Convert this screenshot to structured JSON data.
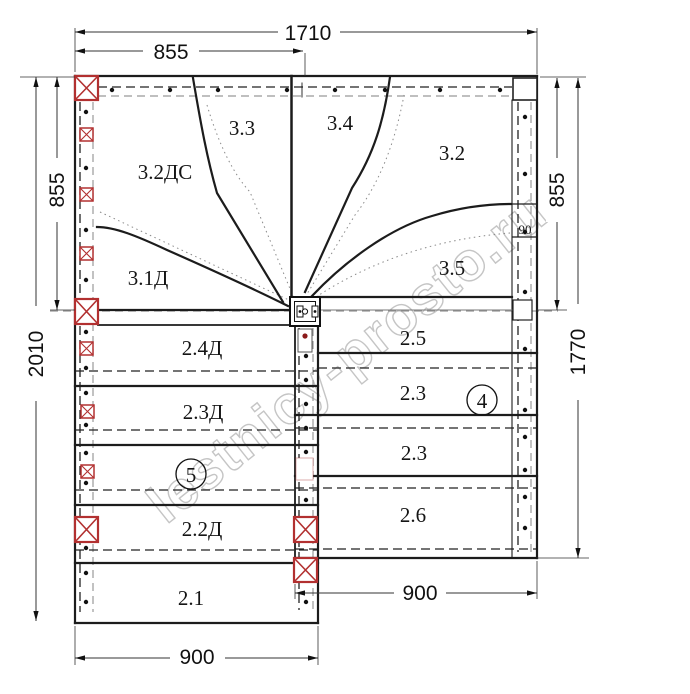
{
  "watermark": "lestnicy-prosto.ru",
  "steps": {
    "winder_left_bottom": "3.1Д",
    "winder_left_mid": "3.2ДС",
    "winder_left_top": "3.3",
    "winder_right_top": "3.4",
    "winder_right_mid": "3.2",
    "winder_right_bottom": "3.5",
    "flight_left": [
      "2.4Д",
      "2.3Д",
      "2.2Д",
      "2.1"
    ],
    "flight_right": [
      "2.5",
      "2.3",
      "2.3",
      "2.6"
    ]
  },
  "flight_numbers": {
    "left": "5",
    "right": "4"
  },
  "dimensions": {
    "total_width": "1710",
    "half_width": "855",
    "left_upper_height": "855",
    "left_total_height": "2010",
    "right_upper_height": "855",
    "right_total_height": "1770",
    "flight_left_width": "900",
    "flight_right_width": "900",
    "stringer_width": "90"
  },
  "colors": {
    "post_red": "#b23030",
    "line": "#1c1c1c",
    "dashed_gray": "#999999",
    "watermark_gray": "#c5c5c5"
  }
}
